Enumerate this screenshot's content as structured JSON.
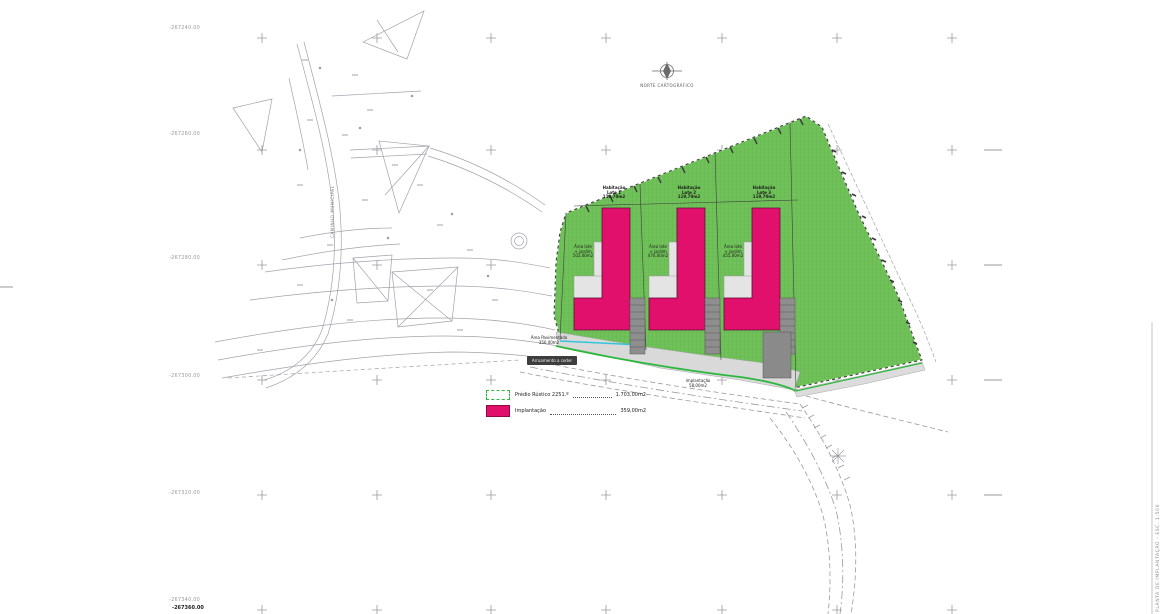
{
  "colors": {
    "parcel_green": "#70c159",
    "hatch_green": "#62b34d",
    "building_pink": "#e0106c",
    "boundary_green": "#2db83d",
    "driveway_gray": "#d9d9d9",
    "stairs_gray": "#8e8e8e",
    "survey_line_gray": "#a3a3a8"
  },
  "north": {
    "label": "NORTE CARTOGRÁFICO"
  },
  "legend": {
    "items": [
      {
        "name": "predio-rustico",
        "label": "Prédio Rústico 2251.º",
        "value": "1.703,00m2"
      },
      {
        "name": "implantacao",
        "label": "Implantação",
        "value": "359,00m2"
      }
    ]
  },
  "grid": {
    "row_labels": [
      "-267240.00",
      "-267260.00",
      "-267280.00",
      "-267300.00",
      "-267320.00",
      "-267340.00"
    ],
    "bottom_label": "-267360.00"
  },
  "lots": [
    {
      "title": [
        "Habitação",
        "Lote 1",
        "119,70m2"
      ],
      "garden": [
        "Área lote",
        "+ jardim",
        "502,00m2"
      ]
    },
    {
      "title": [
        "Habitação",
        "Lote 2",
        "119,70m2"
      ],
      "garden": [
        "Área lote",
        "+ jardim",
        "476,00m2"
      ]
    },
    {
      "title": [
        "Habitação",
        "Lote 3",
        "119,70m2"
      ],
      "garden": [
        "Área lote",
        "+ jardim",
        "455,00m2"
      ]
    }
  ],
  "annotations": {
    "paved": [
      "Área Pavimentada",
      "350,00m2"
    ],
    "road_badge": [
      "Arruamento",
      "a ceder"
    ],
    "implant": [
      "implantação",
      "58,00m2"
    ],
    "street_label": "CAMINHO MUNICIPAL",
    "side_stamp": "PLANTA DE IMPLANTAÇÃO - ESC. 1:500"
  }
}
